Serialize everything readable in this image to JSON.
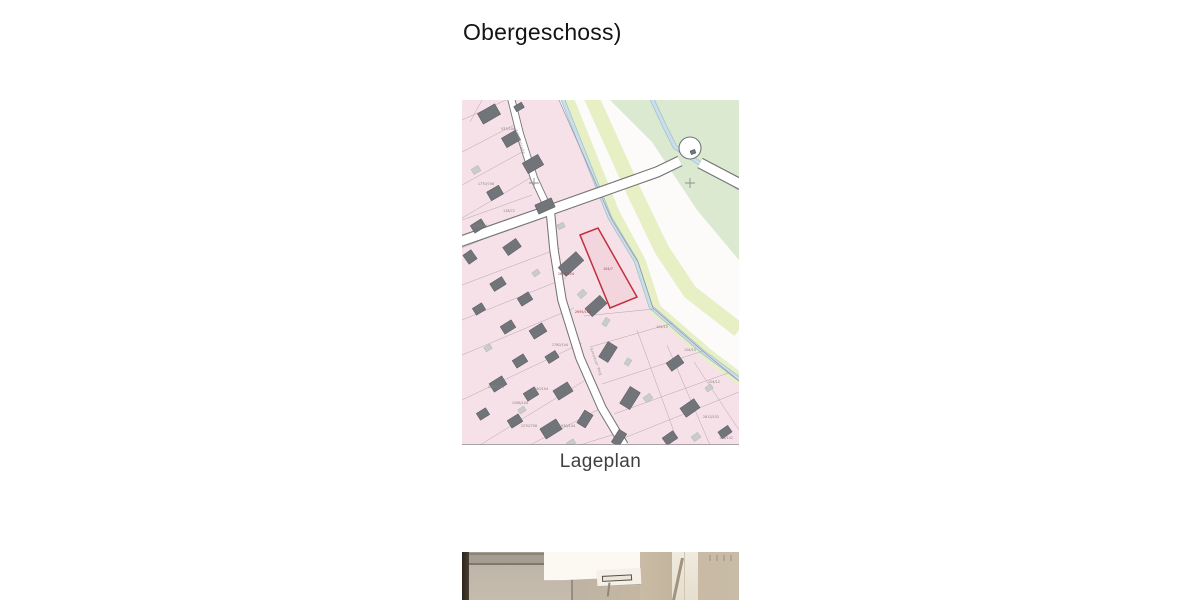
{
  "page": {
    "background": "#ffffff"
  },
  "heading": {
    "text": "Obergeschoss)"
  },
  "map": {
    "caption": "Lageplan",
    "legend_colors": {
      "parcel_pink": "#f6e1e9",
      "building_dark": "#71757a",
      "building_light": "#c9cdc9",
      "greenway": "#e7efc5",
      "field_green": "#dbe9d0",
      "water_blue": "#c8dfeb",
      "road_white": "#ffffff",
      "road_casing": "#757575",
      "highlight_red": "#c12f3d"
    },
    "street_labels": [
      {
        "text": "Amselstraße",
        "x": 57,
        "y": 42,
        "rotate": 72
      },
      {
        "text": "Gronauer Weg",
        "x": 133,
        "y": 262,
        "rotate": 70
      }
    ],
    "parcel_labels": [
      {
        "text": "537/104",
        "x": 46,
        "y": 30
      },
      {
        "text": "1770/708",
        "x": 24,
        "y": 85
      },
      {
        "text": "128/72",
        "x": 47,
        "y": 112
      },
      {
        "text": "1178/104",
        "x": 17,
        "y": 127
      },
      {
        "text": "2694/104",
        "x": 104,
        "y": 175,
        "color": "#a04848"
      },
      {
        "text": "104/7",
        "x": 146,
        "y": 170,
        "color": "#a04848"
      },
      {
        "text": "2695/104",
        "x": 121,
        "y": 213,
        "color": "#a04848"
      },
      {
        "text": "1780/104",
        "x": 98,
        "y": 246
      },
      {
        "text": "104/15",
        "x": 200,
        "y": 228
      },
      {
        "text": "104/13",
        "x": 228,
        "y": 251
      },
      {
        "text": "104/12",
        "x": 252,
        "y": 283
      },
      {
        "text": "2813/152",
        "x": 249,
        "y": 318
      },
      {
        "text": "128/152",
        "x": 264,
        "y": 339
      },
      {
        "text": "1262/104",
        "x": 34,
        "y": 288
      },
      {
        "text": "1340/104",
        "x": 78,
        "y": 290
      },
      {
        "text": "1268/104",
        "x": 58,
        "y": 304
      },
      {
        "text": "1270/708",
        "x": 67,
        "y": 327
      },
      {
        "text": "1930/104",
        "x": 105,
        "y": 327
      }
    ]
  }
}
